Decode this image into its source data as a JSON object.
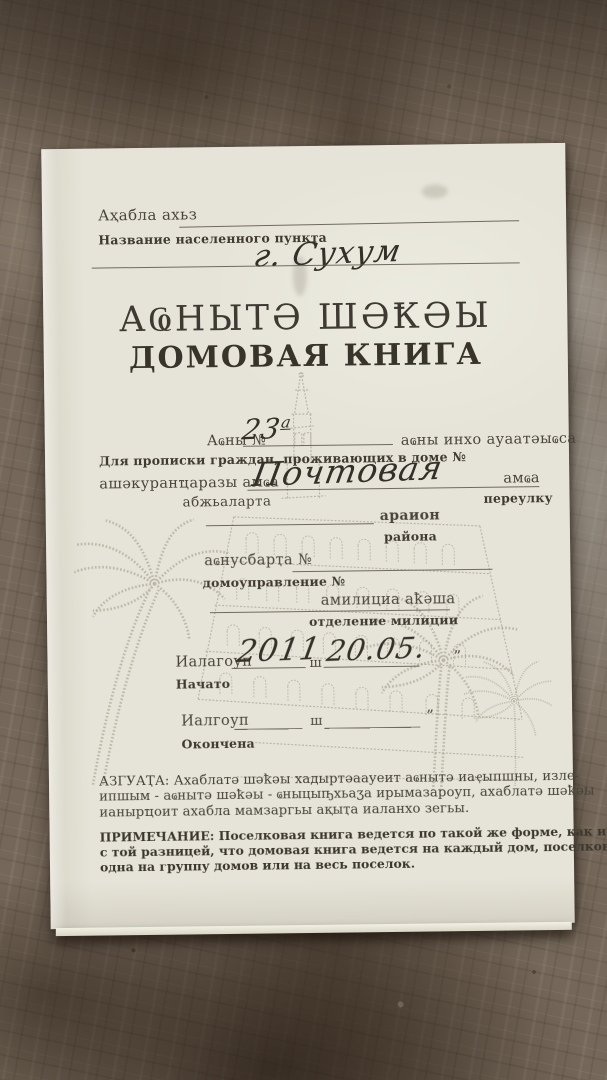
{
  "photo": {
    "paper_color": "#e6e4d8",
    "ink_color": "#474138",
    "sketch_color": "#97917f",
    "background": "marble-countertop"
  },
  "doc": {
    "settlement": {
      "abkhaz": "Аҳабла ахьз",
      "russian": "Название населенного пункта",
      "value": "г. Сухум"
    },
    "title": {
      "abkhaz": "АҨНЫТӘ ШӘҞӘЫ",
      "russian": "ДОМОВАЯ КНИГА"
    },
    "house": {
      "abkhaz_prefix": "Аҩны №",
      "number": "23",
      "number_sup": "а",
      "abkhaz_suffix": "аҩны инхо ауаатәыҩса",
      "russian": "Для прописки граждан, проживающих в доме №"
    },
    "street": {
      "abkhaz_prefix": "ашәкуранҵаразы амҩа",
      "value": "Почтовая",
      "abkhaz_suffix": "амҩа",
      "abkhaz_sub": "абжьаларта",
      "russian_sub": "переулку"
    },
    "district": {
      "abkhaz": "араион",
      "russian": "района"
    },
    "housing_office": {
      "abkhaz": "аҩнусбарҭа №",
      "russian": "домоуправление №"
    },
    "police": {
      "abkhaz": "амилициа аҟәша",
      "russian": "отделение милиции"
    },
    "started": {
      "abkhaz": "Иалагоуп",
      "russian": "Начато",
      "year": "2011",
      "unit": "ш",
      "date": "20.05.",
      "quote": "”"
    },
    "finished": {
      "abkhaz": "Иалгоуп",
      "russian": "Окончена",
      "unit": "ш",
      "quote": "”"
    },
    "azguata": {
      "line1": "АЗГУАҬА: Ахаблатә шәҟәы хадыртәаауеит аҩнытә иаҿыпшны, изле-",
      "line2": "ипшым - аҩнытә шәҟәы - ҩныцыҧхьаӡа ирымазароуп, ахаблатә шәҟәы",
      "line3": "ианырҵоит ахабла мамзаргьы ақыҭа иаланхо зегьы."
    },
    "note": {
      "line1": "ПРИМЕЧАНИЕ: Поселковая книга ведется по такой же форме, как и домовая,",
      "line2": "с той разницей, что домовая книга ведется на каждый дом, поселковая -",
      "line3": "одна на группу домов или на весь поселок."
    }
  }
}
